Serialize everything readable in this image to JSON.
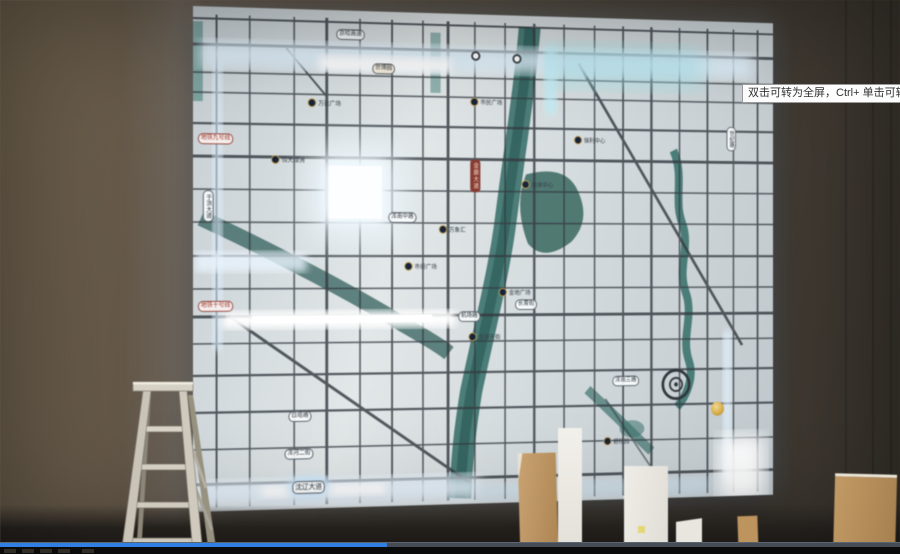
{
  "player": {
    "tooltip_text": "双击可转为全屏，Ctrl+ 单击可转为",
    "progress_percent": 43,
    "colors": {
      "progress_fill": "#2f80e2",
      "progress_track": "#454c54"
    }
  },
  "scene": {
    "objects": [
      "illuminated map wall panel",
      "aluminum stepladder",
      "white and cardboard packing boards"
    ],
    "wall_color": "#5c5244"
  },
  "map": {
    "colors": {
      "panel": "#dfe5e6",
      "river": "#39736d",
      "road": "#343b42",
      "glow": "#eaf6ff",
      "metro_red": "#9c2f24"
    },
    "road_labels": [
      {
        "text": "京哈高速"
      },
      {
        "text": "世博园"
      },
      {
        "text": "白塔路"
      },
      {
        "text": "浑河二街"
      },
      {
        "text": "沈辽大道"
      },
      {
        "text": "机场路"
      },
      {
        "text": "长青街"
      },
      {
        "text": "浑南三路"
      },
      {
        "text": "于洪大道"
      },
      {
        "text": "世纪路"
      },
      {
        "text": "浑南中路"
      }
    ],
    "metro_labels": [
      {
        "text": "地铁九号线"
      },
      {
        "text": "地铁十号线"
      }
    ],
    "vertical_red_label": "金廊大道",
    "poi_labels": [
      {
        "text": "万达广场"
      },
      {
        "text": "市民广场"
      },
      {
        "text": "保利中心"
      },
      {
        "text": "恒大绿洲"
      },
      {
        "text": "奥体中心"
      },
      {
        "text": "万象汇"
      },
      {
        "text": "金地广场"
      },
      {
        "text": "龙湖天街"
      },
      {
        "text": "碧桂园"
      },
      {
        "text": "市府广场"
      }
    ]
  }
}
